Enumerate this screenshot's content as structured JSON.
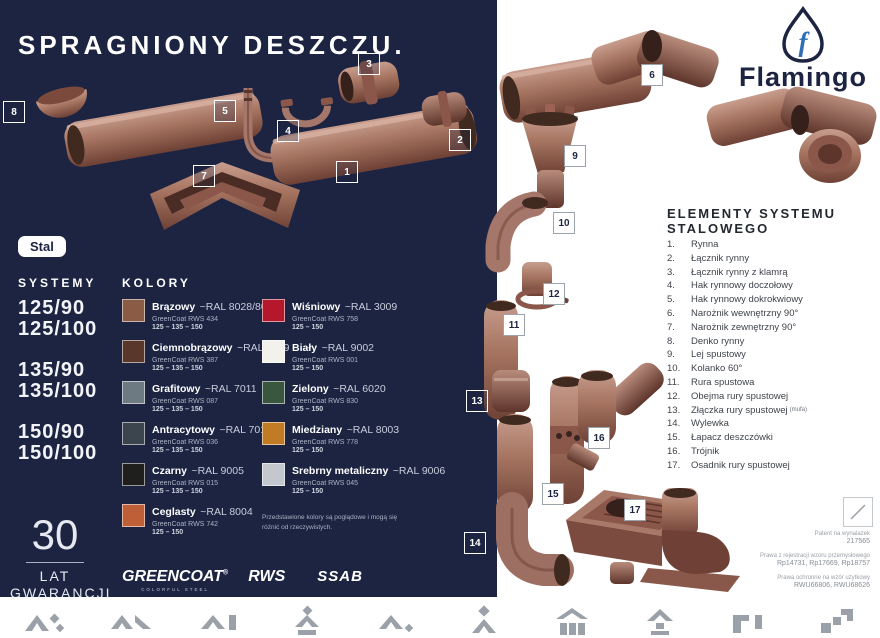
{
  "page": {
    "title": "SPRAGNIONY DESZCZU.",
    "material_badge": "Stal",
    "brand": "Flamingo"
  },
  "systems": {
    "heading": "SYSTEMY",
    "items": [
      "125/90",
      "125/100",
      "135/90",
      "135/100",
      "150/90",
      "150/100"
    ]
  },
  "colors": {
    "heading": "KOLORY",
    "note": "Przedstawione kolory są poglądowe i mogą się różnić od rzeczywistych.",
    "items": [
      {
        "name": "Brązowy",
        "ral": "~RAL 8028/8017",
        "greencoat": "GreenCoat RWS 434",
        "sizes": "125 – 135 – 150",
        "hex": "#8a5c46"
      },
      {
        "name": "Wiśniowy",
        "ral": "~RAL 3009",
        "greencoat": "GreenCoat RWS 758",
        "sizes": "125 – 150",
        "hex": "#b5182c"
      },
      {
        "name": "Ciemnobrązowy",
        "ral": "~RAL 8019",
        "greencoat": "GreenCoat RWS 387",
        "sizes": "125 – 135 – 150",
        "hex": "#59382b"
      },
      {
        "name": "Biały",
        "ral": "~RAL 9002",
        "greencoat": "GreenCoat RWS 001",
        "sizes": "125 – 150",
        "hex": "#f2f1ec"
      },
      {
        "name": "Grafitowy",
        "ral": "~RAL 7011",
        "greencoat": "GreenCoat RWS 087",
        "sizes": "125 – 135 – 150",
        "hex": "#6d7a81"
      },
      {
        "name": "Zielony",
        "ral": "~RAL 6020",
        "greencoat": "GreenCoat RWS 830",
        "sizes": "125 – 150",
        "hex": "#39573f"
      },
      {
        "name": "Antracytowy",
        "ral": "~RAL 7016",
        "greencoat": "GreenCoat RWS 036",
        "sizes": "125 – 135 – 150",
        "hex": "#3c444e"
      },
      {
        "name": "Miedziany",
        "ral": "~RAL 8003",
        "greencoat": "GreenCoat RWS 778",
        "sizes": "125 – 150",
        "hex": "#c17b25"
      },
      {
        "name": "Czarny",
        "ral": "~RAL 9005",
        "greencoat": "GreenCoat RWS 015",
        "sizes": "125 – 135 – 150",
        "hex": "#1f1f1d"
      },
      {
        "name": "Srebrny metaliczny",
        "ral": "~RAL 9006",
        "greencoat": "GreenCoat RWS 045",
        "sizes": "125 – 150",
        "hex": "#c4c8ce"
      },
      {
        "name": "Ceglasty",
        "ral": "~RAL 8004",
        "greencoat": "GreenCoat RWS 742",
        "sizes": "125 – 150",
        "hex": "#bf5f38"
      }
    ]
  },
  "warranty": {
    "years": "30",
    "line1": "LAT",
    "line2": "GWARANCJI"
  },
  "partner_logos": {
    "greencoat": "GREENCOAT",
    "greencoat_reg": "®",
    "greencoat_sub": "COLORFUL STEEL",
    "rws": "RWS",
    "ssab": "SSAB"
  },
  "elements": {
    "heading": "ELEMENTY SYSTEMU STALOWEGO",
    "items": [
      {
        "num": "1.",
        "label": "Rynna"
      },
      {
        "num": "2.",
        "label": "Łącznik rynny"
      },
      {
        "num": "3.",
        "label": "Łącznik rynny z klamrą"
      },
      {
        "num": "4.",
        "label": "Hak rynnowy doczołowy"
      },
      {
        "num": "5.",
        "label": "Hak rynnowy dokrokwiowy"
      },
      {
        "num": "6.",
        "label": "Narożnik wewnętrzny 90°"
      },
      {
        "num": "7.",
        "label": "Narożnik zewnętrzny 90°"
      },
      {
        "num": "8.",
        "label": "Denko rynny"
      },
      {
        "num": "9.",
        "label": "Lej spustowy"
      },
      {
        "num": "10.",
        "label": "Kolanko 60°"
      },
      {
        "num": "11.",
        "label": "Rura spustowa"
      },
      {
        "num": "12.",
        "label": "Obejma rury spustowej"
      },
      {
        "num": "13.",
        "label": "Złączka rury spustowej",
        "suffix": "(mufa)"
      },
      {
        "num": "14.",
        "label": "Wylewka"
      },
      {
        "num": "15.",
        "label": "Łapacz deszczówki"
      },
      {
        "num": "16.",
        "label": "Trójnik"
      },
      {
        "num": "17.",
        "label": "Osadnik rury spustowej"
      }
    ]
  },
  "legal": {
    "patent_label": "Patent na wynalazek",
    "patent_no": "217565",
    "design_label": "Prawa z rejestracji wzoru przemysłowego",
    "design_nos": "Rp14731, Rp17669, Rp18757",
    "utility_label": "Prawa ochronne na wzór użytkowy",
    "utility_nos": "RWU66806, RWU68626"
  },
  "diagram": {
    "badges": [
      "1",
      "2",
      "3",
      "4",
      "5",
      "6",
      "7",
      "8",
      "9",
      "10",
      "11",
      "12",
      "13",
      "14",
      "15",
      "16",
      "17"
    ]
  },
  "theme": {
    "navy": "#1c2442",
    "copper": "#a5735f",
    "accent_blue": "#2f6db5"
  }
}
